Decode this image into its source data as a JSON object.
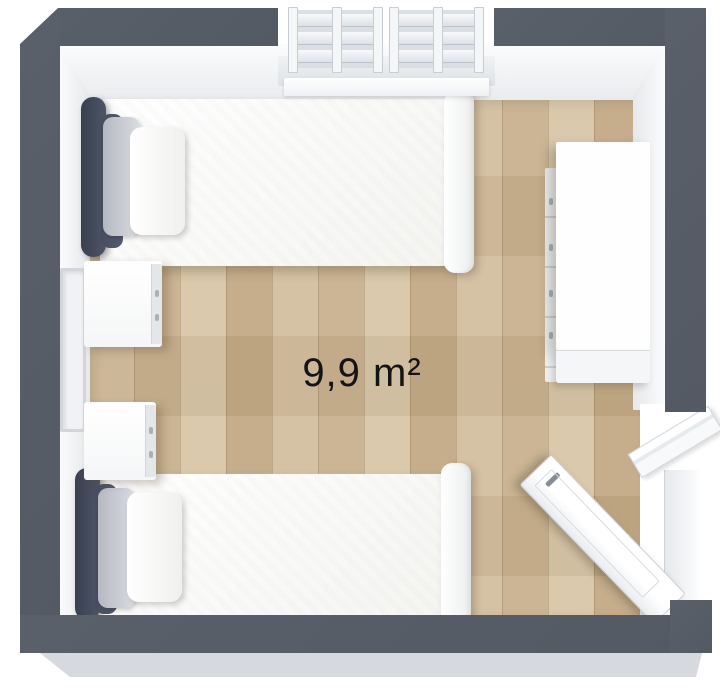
{
  "floorplan": {
    "area_label": "9,9 m²",
    "colors": {
      "wall": "#575d66",
      "wall_outer_edge": "#d6d9dd",
      "wall_inner_face": "#f2f4f6",
      "floor_wood_light": "#d8c6a8",
      "floor_wood_dark": "#c3aa86",
      "headboard_navy": "#404759",
      "pillow_gray": "#c6cad1",
      "furniture_white": "#fdfdfd",
      "label_text": "#141414"
    },
    "items": {
      "bed_top": "single bed",
      "bed_bottom": "single bed",
      "nightstand_top": "nightstand",
      "nightstand_bottom": "nightstand",
      "dresser_right": "dresser",
      "window_top_wall": "double window",
      "window_left_wall": "window",
      "door_bottom_right": "open door"
    }
  }
}
